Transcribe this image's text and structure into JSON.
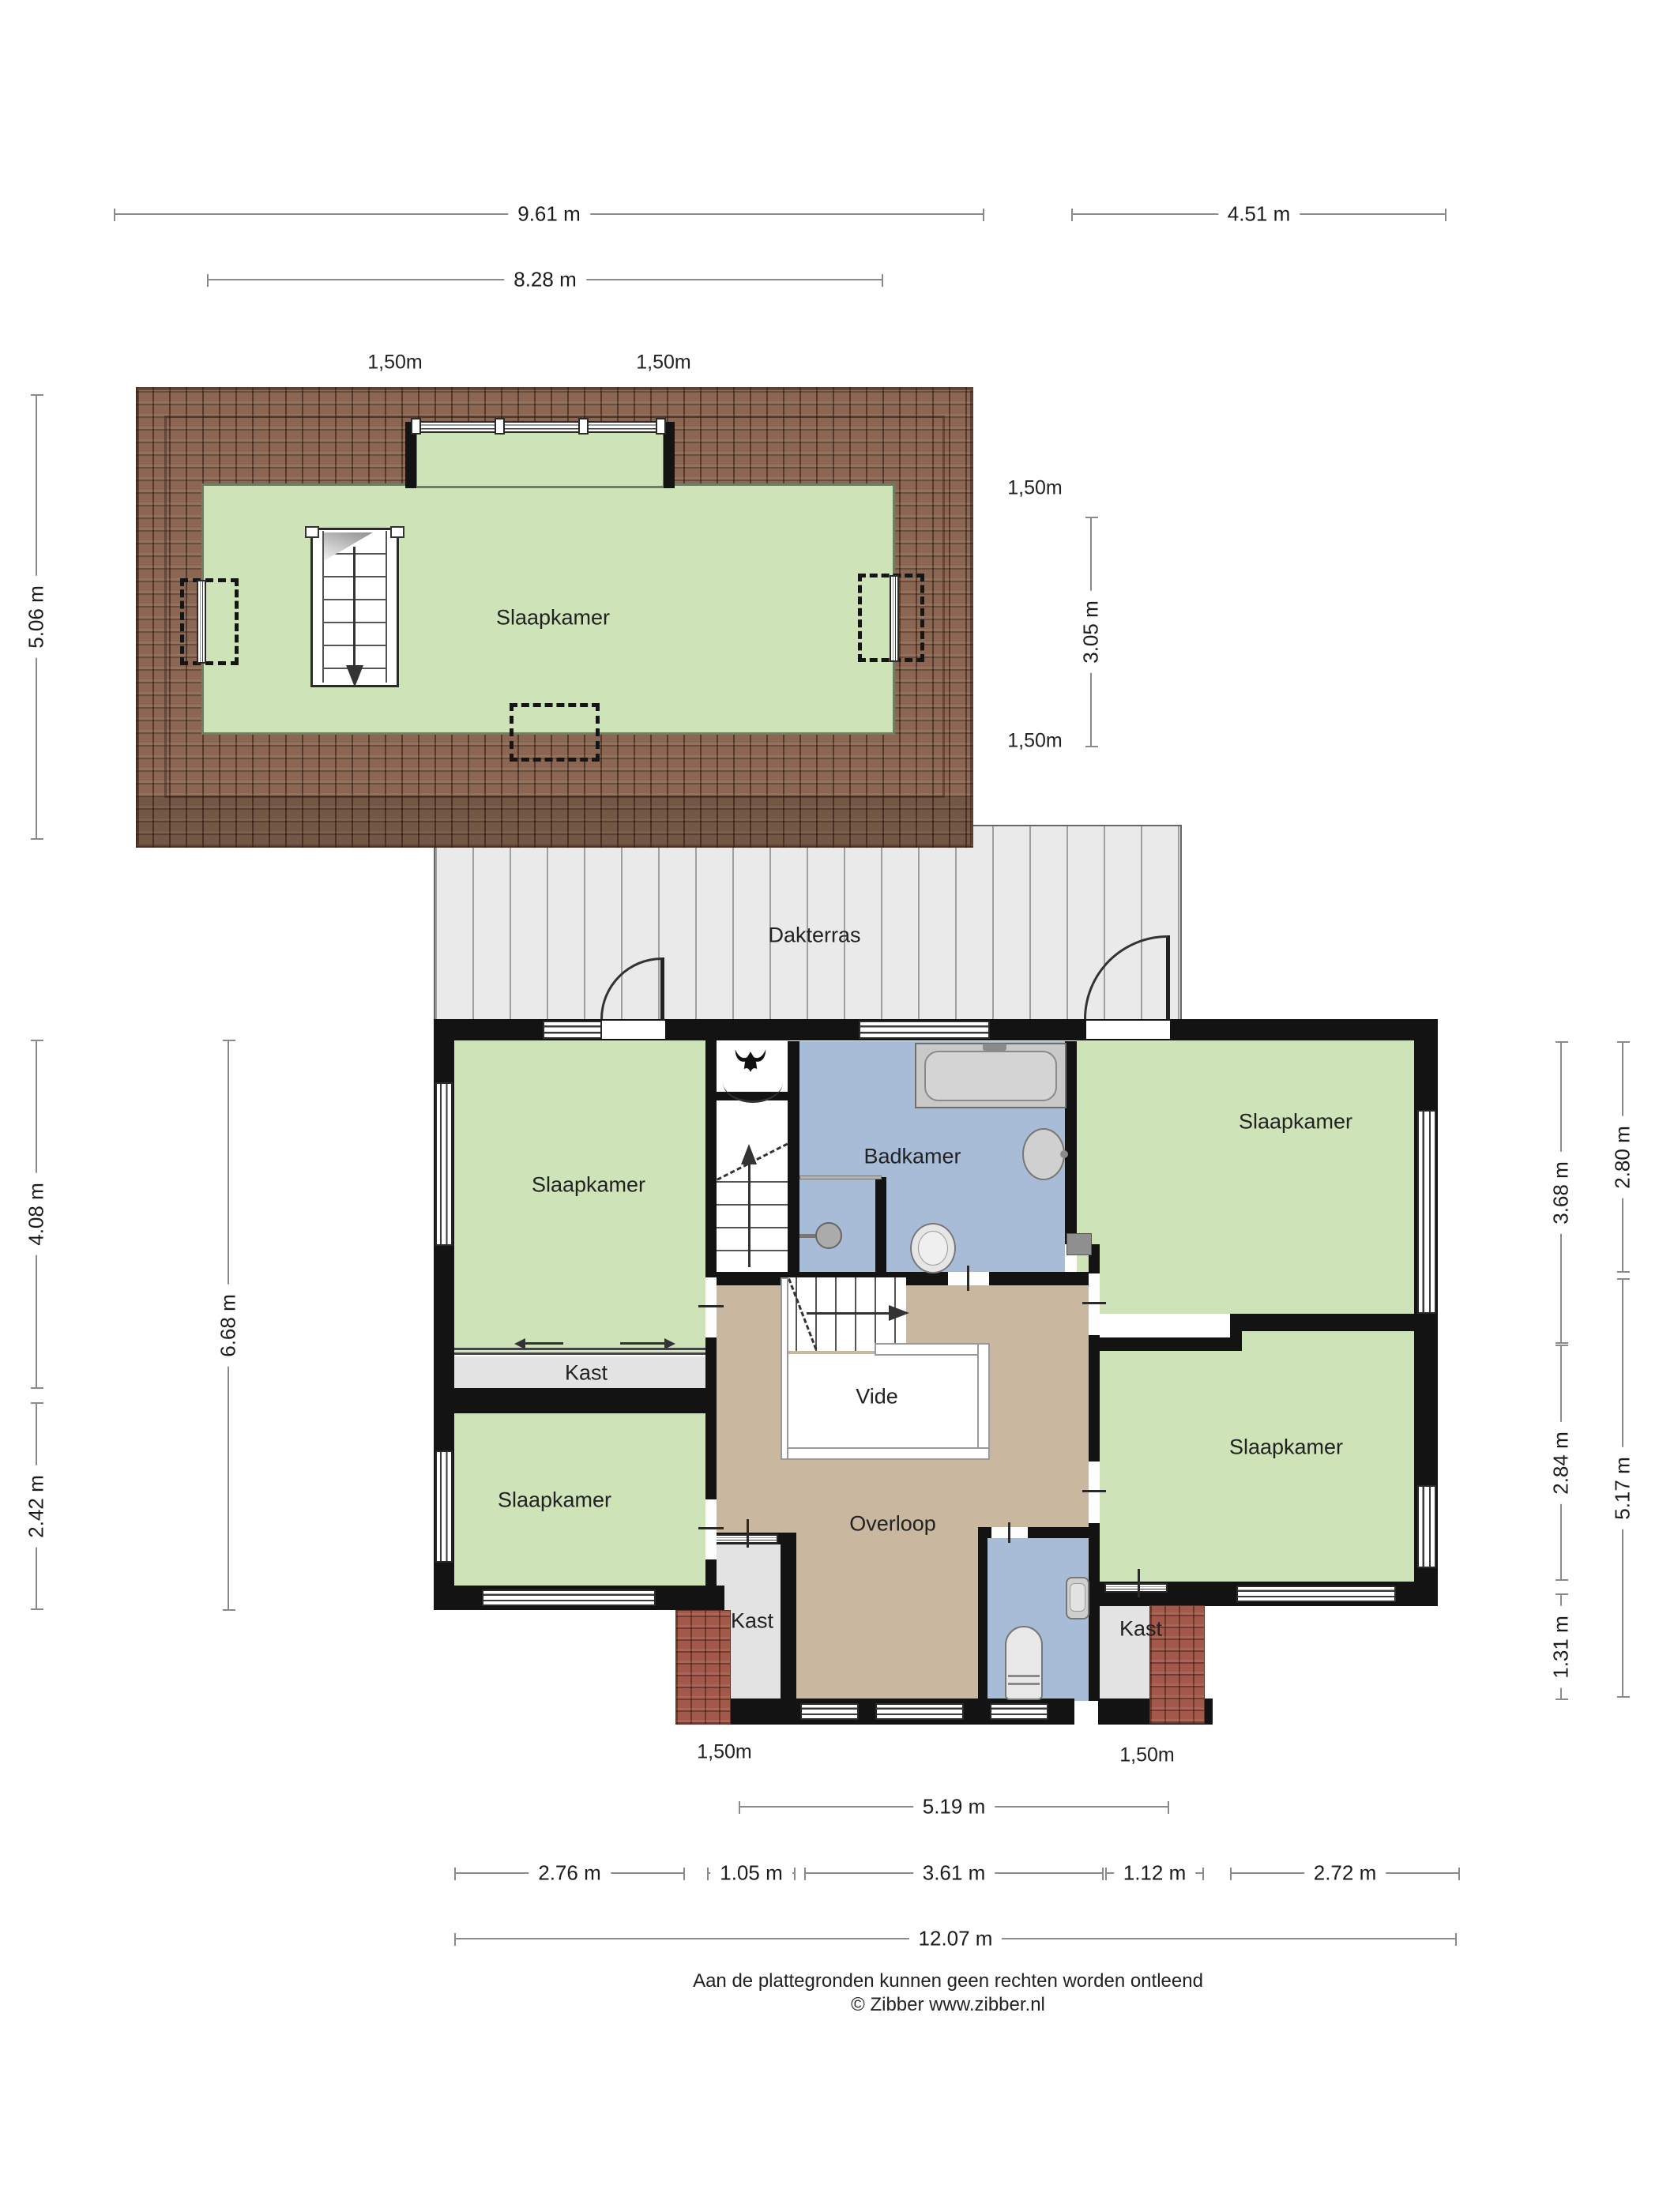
{
  "labels": {
    "attic_room": "Slaapkamer",
    "dakterras": "Dakterras",
    "slaapkamer_tl": "Slaapkamer",
    "slaapkamer_tr": "Slaapkamer",
    "slaapkamer_bl": "Slaapkamer",
    "slaapkamer_br": "Slaapkamer",
    "badkamer": "Badkamer",
    "vide": "Vide",
    "overloop": "Overloop",
    "kast_left": "Kast",
    "kast_bottom": "Kast",
    "kast_right": "Kast"
  },
  "dimensions": {
    "attic_total_width": "9.61 m",
    "upper_right_width": "4.51 m",
    "attic_inner_width": "8.28 m",
    "attic_height_left": "5.06 m",
    "attic_height_right": "3.05 m",
    "marker_attic_top_left": "1,50m",
    "marker_attic_top_right": "1,50m",
    "marker_attic_right_upper": "1,50m",
    "marker_attic_right_lower": "1,50m",
    "floor_left_upper": "4.08 m",
    "floor_left_lower": "2.42 m",
    "floor_left_total": "6.68 m",
    "floor_right_upper": "3.68 m",
    "floor_right_middle": "2.84 m",
    "floor_right_lower": "1.31 m",
    "floor_right_outer_upper": "2.80 m",
    "floor_right_outer_lower": "5.17 m",
    "marker_floor_bottom_left": "1,50m",
    "marker_floor_bottom_right": "1,50m",
    "floor_bottom_span": "5.19 m",
    "floor_bottom_1": "2.76 m",
    "floor_bottom_2": "1.05 m",
    "floor_bottom_3": "3.61 m",
    "floor_bottom_4": "1.12 m",
    "floor_bottom_5": "2.72 m",
    "floor_bottom_total": "12.07 m"
  },
  "footer": {
    "disclaimer": "Aan de plattegronden kunnen geen rechten worden ontleend",
    "copyright": "© Zibber www.zibber.nl"
  },
  "colors": {
    "room_green": "#cfe3b8",
    "bathroom_blue": "#a8bcd7",
    "hall_tan": "#c9b7a0",
    "closet_gray": "#e3e3e3",
    "roof_brown": "#8b6753",
    "roof_red": "#a2594a",
    "terrace_gray": "#eaeaea",
    "wall_black": "#131313"
  }
}
